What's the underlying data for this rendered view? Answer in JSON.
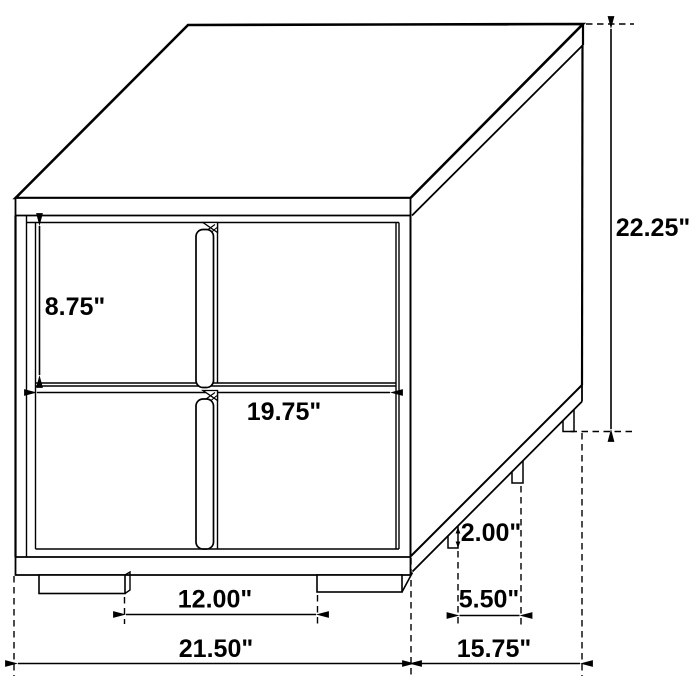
{
  "drawing": {
    "type": "furniture-dimension-diagram",
    "subject": "two-drawer nightstand line drawing",
    "line_color": "#000000",
    "background_color": "#ffffff",
    "dimensions": {
      "overall_height": "22.25\"",
      "drawer_front_height": "8.75\"",
      "drawer_front_width": "19.75\"",
      "foot_height": "2.00\"",
      "side_foot_spacing": "5.50\"",
      "front_foot_spacing": "12.00\"",
      "overall_width": "21.50\"",
      "overall_depth": "15.75\""
    }
  }
}
